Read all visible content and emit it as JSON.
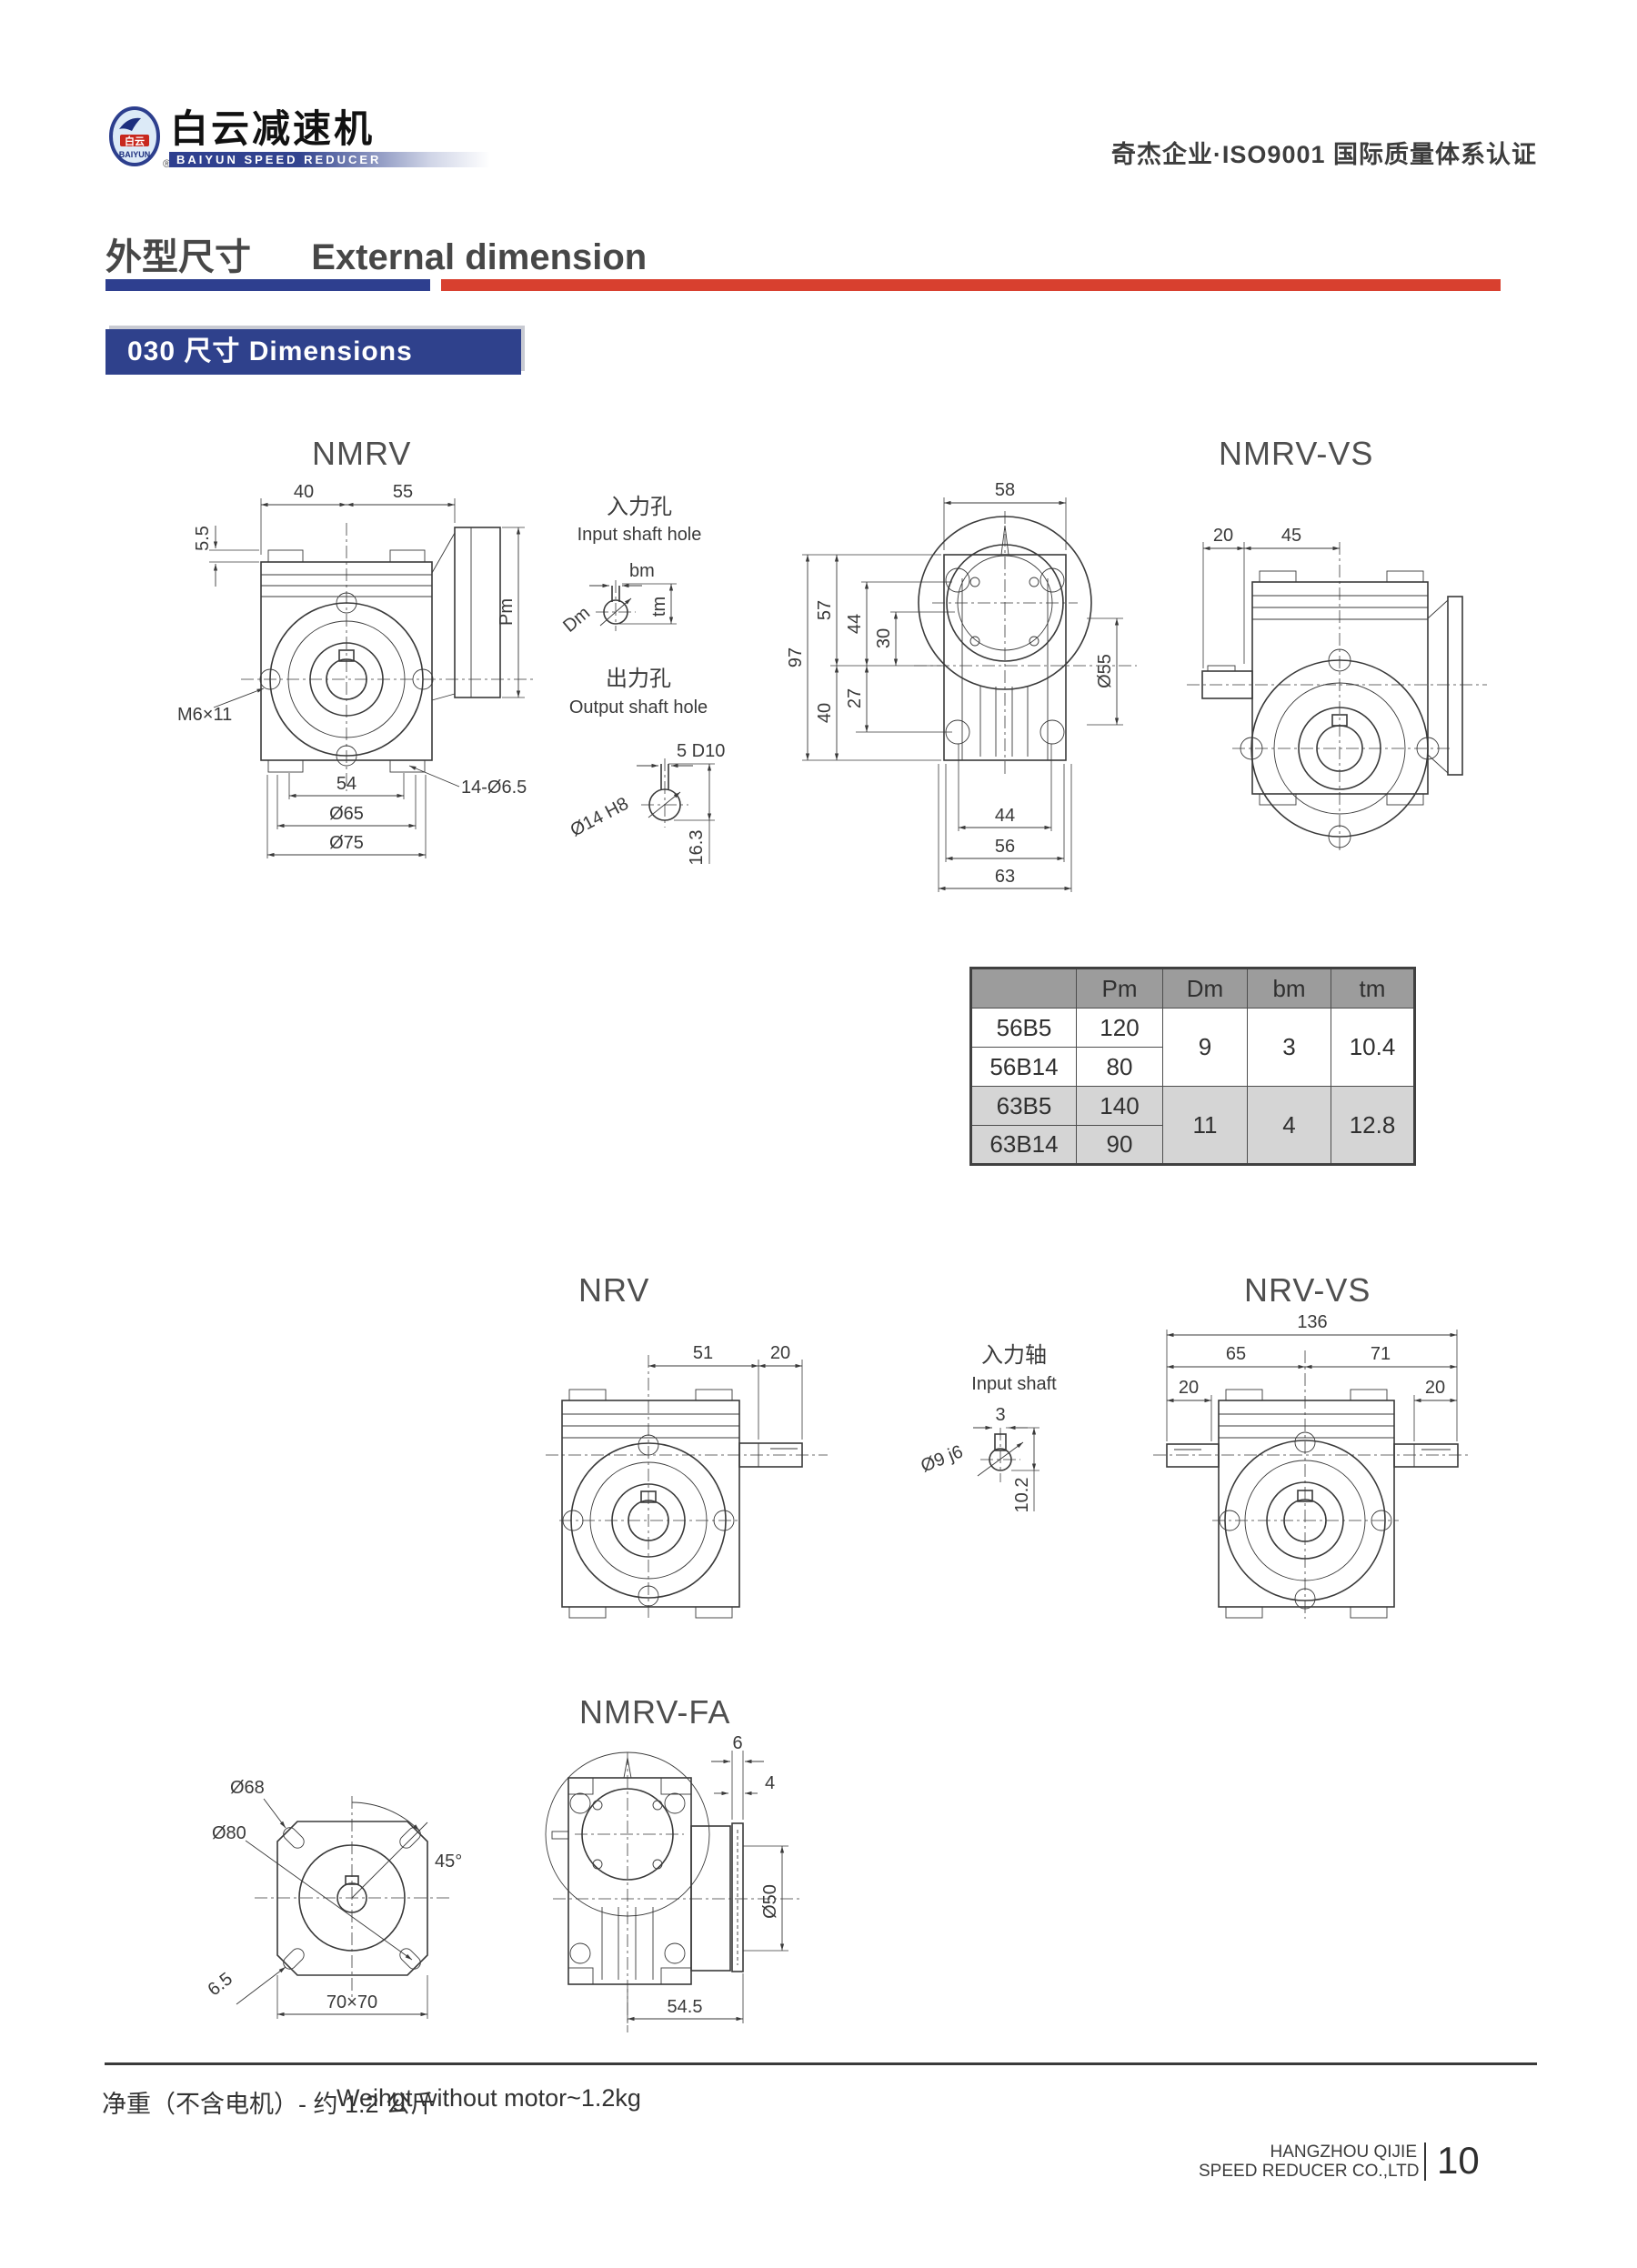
{
  "header": {
    "logo_cn": "白云减速机",
    "logo_en": "BAIYUN SPEED REDUCER",
    "emblem_cn": "白云",
    "emblem_en": "BAIYUN",
    "reg_mark": "®",
    "cert": "奇杰企业·ISO9001 国际质量体系认证"
  },
  "section": {
    "title_cn": "外型尺寸",
    "title_en": "External dimension"
  },
  "banner": {
    "label": "030 尺寸  Dimensions"
  },
  "colors": {
    "brand_blue": "#2e3f8f",
    "accent_red": "#d8402f",
    "table_header_gray": "#9c9c9c",
    "table_shade_gray": "#d5d5d5"
  },
  "drawings": {
    "nmrv": {
      "title": "NMRV",
      "top40": "40",
      "top55": "55",
      "left55": "5.5",
      "pm": "Pm",
      "m6": "M6×11",
      "b54": "54",
      "b65": "Ø65",
      "b75": "Ø75",
      "holes": "14-Ø6.5"
    },
    "input_hole": {
      "cn": "入力孔",
      "en": "Input shaft hole",
      "bm": "bm",
      "dm": "Dm",
      "tm": "tm"
    },
    "output_hole": {
      "cn": "出力孔",
      "en": "Output shaft hole",
      "key": "5 D10",
      "bore": "Ø14 H8",
      "depth": "16.3"
    },
    "rear_view": {
      "t58": "58",
      "l97": "97",
      "l57": "57",
      "l44": "44",
      "l30": "30",
      "l27": "27",
      "l40": "40",
      "r55": "Ø55",
      "b44": "44",
      "b56": "56",
      "b63": "63"
    },
    "nmrv_vs": {
      "title": "NMRV-VS",
      "t20": "20",
      "t45": "45"
    },
    "nrv": {
      "title": "NRV",
      "t51": "51",
      "t20": "20"
    },
    "input_shaft": {
      "cn": "入力轴",
      "en": "Input shaft",
      "t3": "3",
      "bore": "Ø9 j6",
      "depth": "10.2"
    },
    "nrv_vs": {
      "title": "NRV-VS",
      "t136": "136",
      "t65": "65",
      "t71": "71",
      "l20": "20",
      "r20": "20"
    },
    "nmrv_fa": {
      "title": "NMRV-FA",
      "d68": "Ø68",
      "d80": "Ø80",
      "a45": "45°",
      "d65": "6.5",
      "sq": "70×70",
      "t6": "6",
      "t4": "4",
      "d50": "Ø50",
      "b545": "54.5"
    }
  },
  "table": {
    "headers": {
      "c0": "",
      "c1": "Pm",
      "c2": "Dm",
      "c3": "bm",
      "c4": "tm"
    },
    "rows": [
      {
        "model": "56B5",
        "pm": "120"
      },
      {
        "model": "56B14",
        "pm": "80"
      },
      {
        "model": "63B5",
        "pm": "140"
      },
      {
        "model": "63B14",
        "pm": "90"
      }
    ],
    "groups": [
      {
        "dm": "9",
        "bm": "3",
        "tm": "10.4"
      },
      {
        "dm": "11",
        "bm": "4",
        "tm": "12.8"
      }
    ]
  },
  "footer": {
    "weight_cn": "净重（不含电机）- 约 1.2 公斤",
    "weight_en": "Weihgt without motor~1.2kg"
  },
  "pagebar": {
    "company1": "HANGZHOU QIJIE",
    "company2": "SPEED REDUCER CO.,LTD",
    "page": "10"
  }
}
